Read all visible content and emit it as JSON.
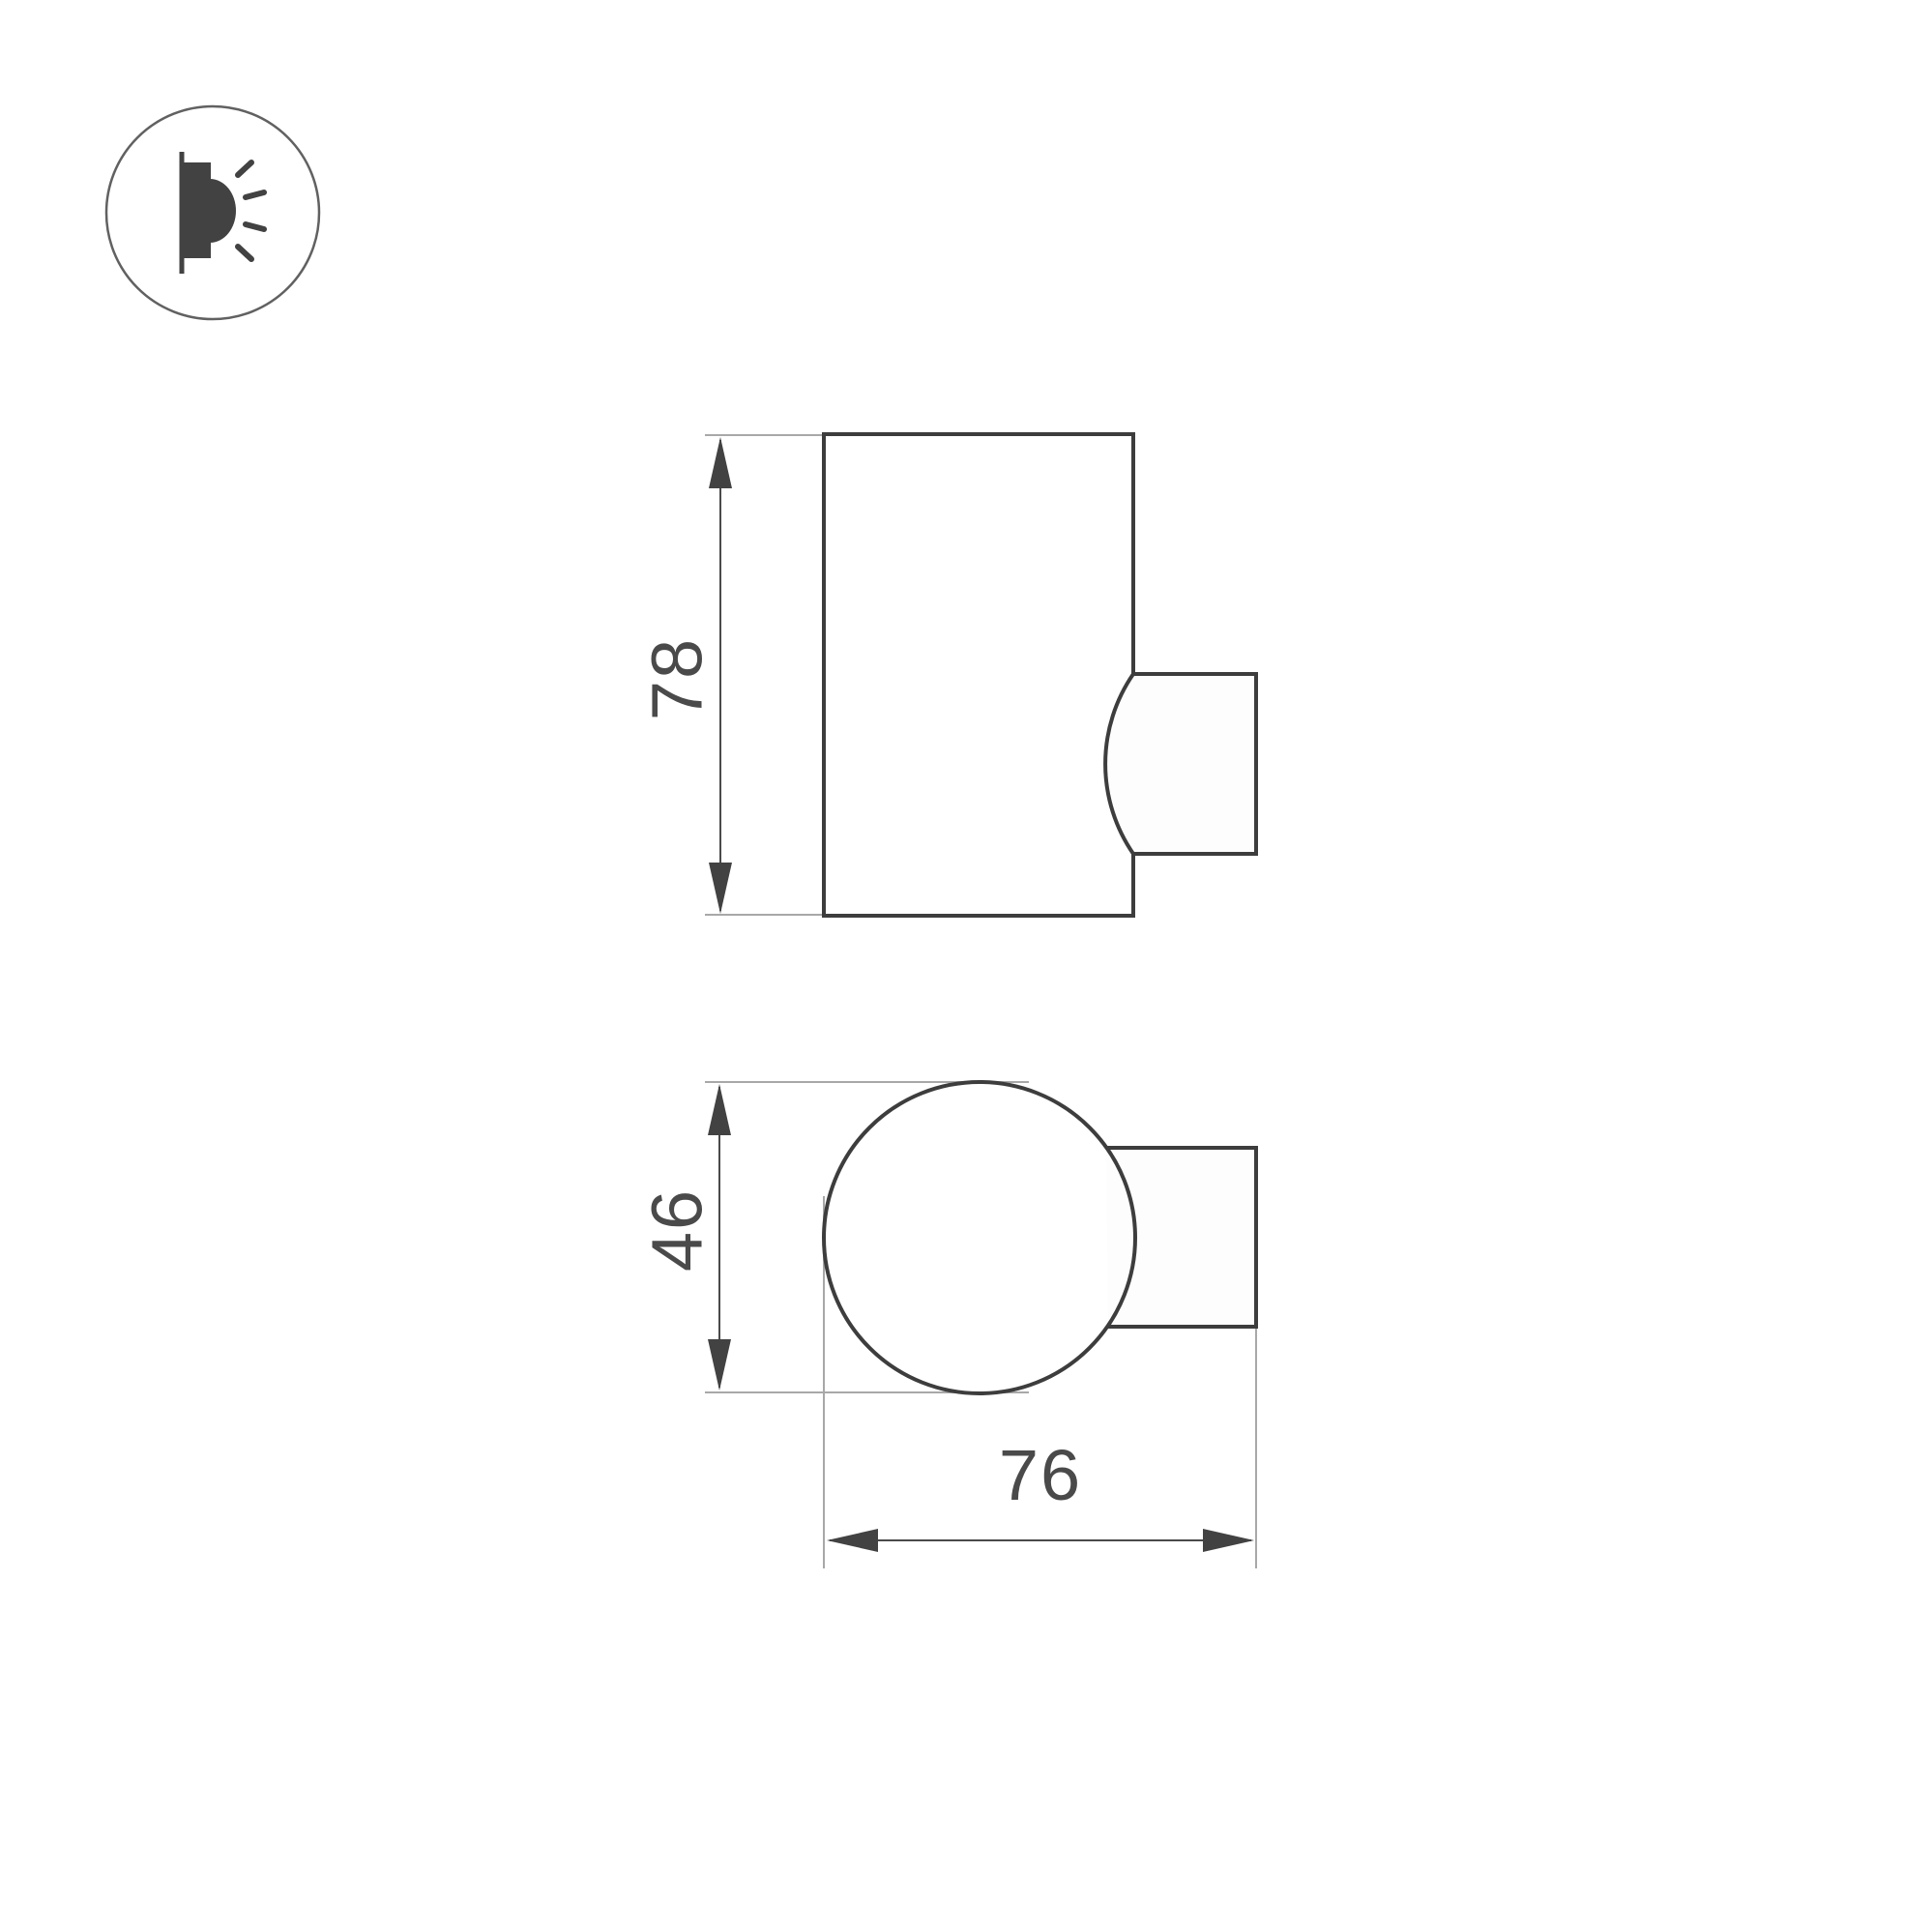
{
  "icon": {
    "type": "wall-light-emission-icon"
  },
  "side_view": {
    "height_label": "78"
  },
  "top_view": {
    "diameter_label": "46",
    "depth_label": "76"
  },
  "colors": {
    "background": "#ffffff",
    "shape_outline": "#3d3d3d",
    "dimension_line": "#4a4a4a",
    "extension_line": "#a8a8a8",
    "label_text": "#4a4a4a",
    "icon_fill": "#424242",
    "icon_circle_outline": "#616161"
  }
}
